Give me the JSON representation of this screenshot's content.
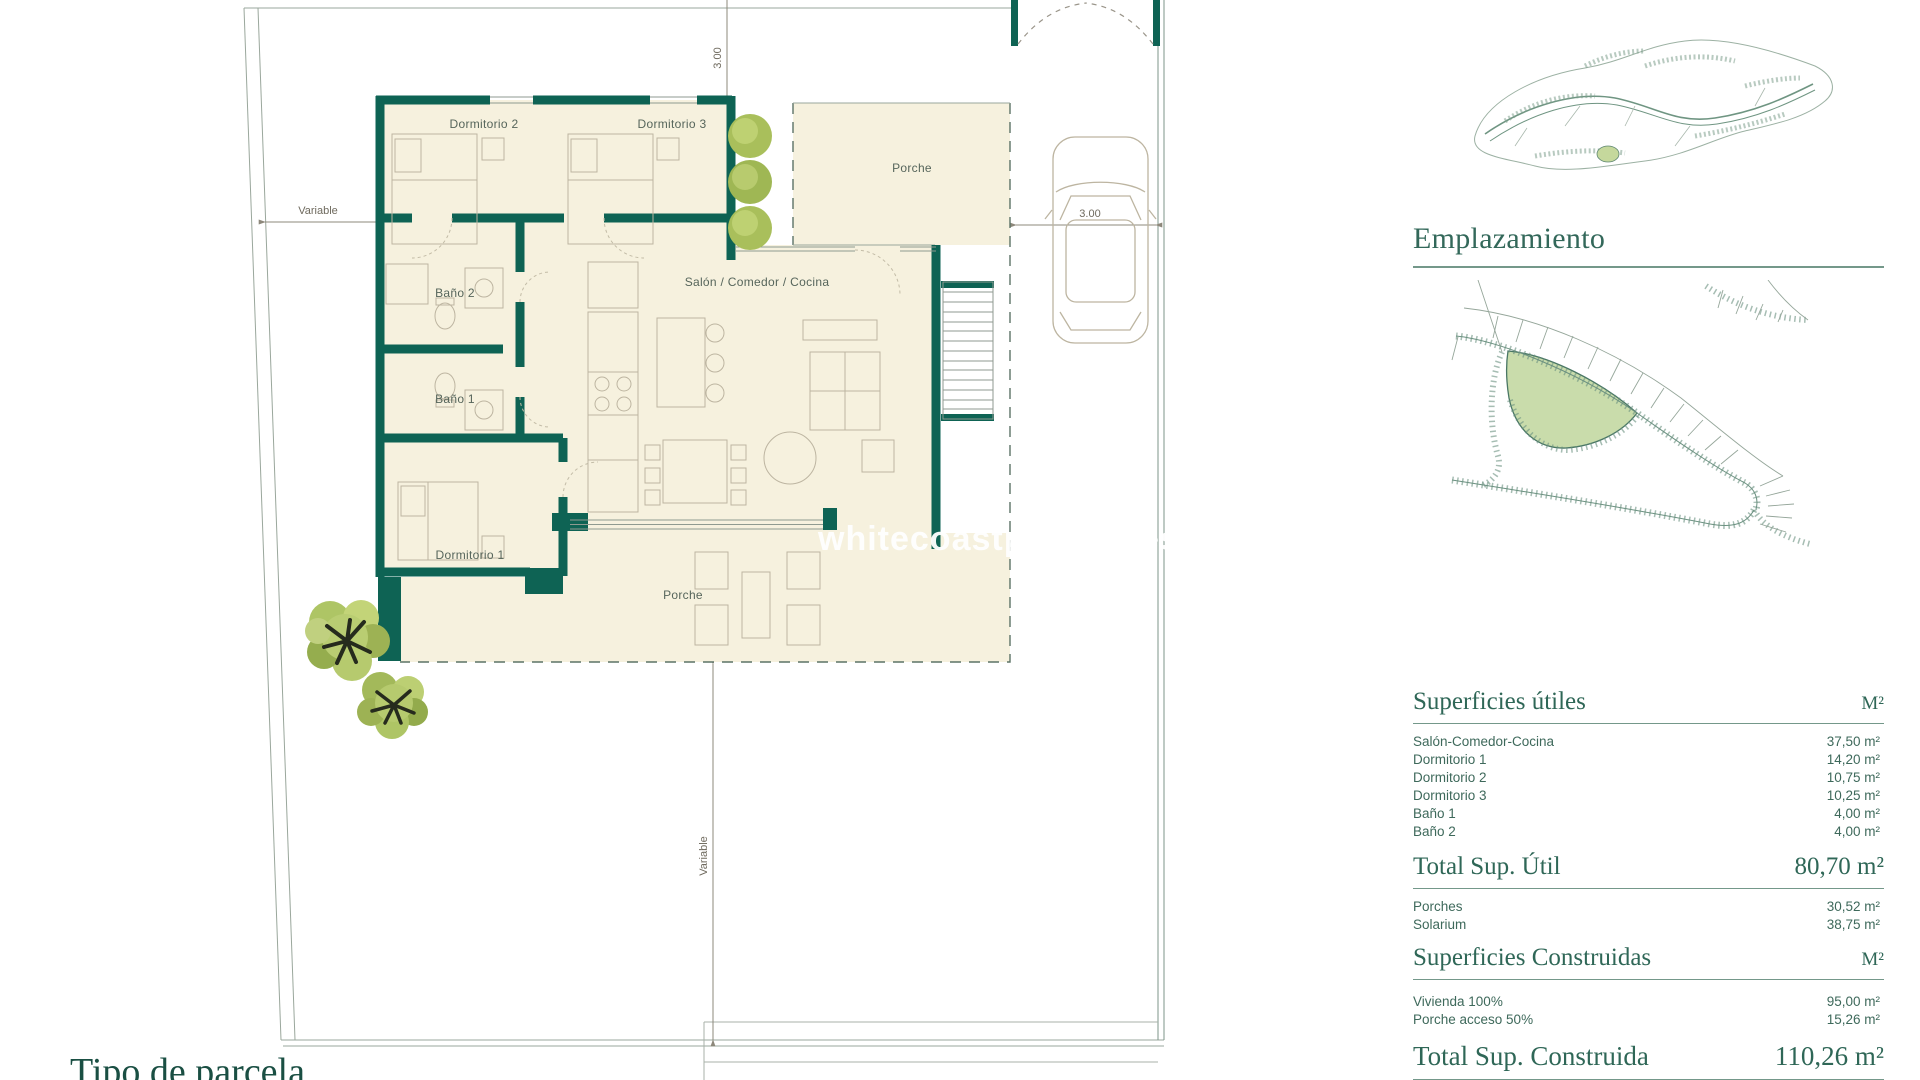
{
  "floor_plan": {
    "watermark": "whitecoastproperties",
    "rooms": {
      "dormitorio2": "Dormitorio 2",
      "dormitorio3": "Dormitorio 3",
      "porche_superior": "Porche",
      "salon": "Salón / Comedor / Cocina",
      "bano2": "Baño 2",
      "bano1": "Baño 1",
      "dormitorio1": "Dormitorio 1",
      "porche_inferior": "Porche"
    },
    "dimensions": {
      "variable_izquierda": "Variable",
      "ancho_superior": "3.00",
      "aparcamiento": "3.00",
      "variable_inferior": "Variable"
    }
  },
  "sidebar": {
    "emplazamiento_title": "Emplazamiento",
    "superficies_utiles": {
      "title": "Superficies útiles",
      "unit": "M²",
      "rows": [
        {
          "name": "Salón-Comedor-Cocina",
          "value": "37,50 m²"
        },
        {
          "name": "Dormitorio 1",
          "value": "14,20 m²"
        },
        {
          "name": "Dormitorio 2",
          "value": "10,75 m²"
        },
        {
          "name": "Dormitorio 3",
          "value": "10,25 m²"
        },
        {
          "name": "Baño 1",
          "value": "4,00 m²"
        },
        {
          "name": "Baño 2",
          "value": "4,00 m²"
        }
      ]
    },
    "total_util": {
      "label": "Total Sup. Útil",
      "value": "80,70 m²"
    },
    "extras": {
      "rows": [
        {
          "name": "Porches",
          "value": "30,52 m²"
        },
        {
          "name": "Solarium",
          "value": "38,75 m²"
        }
      ]
    },
    "superficies_construidas": {
      "title": "Superficies Construidas",
      "unit": "M²",
      "rows": [
        {
          "name": "Vivienda 100%",
          "value": "95,00 m²"
        },
        {
          "name": "Porche acceso 50%",
          "value": "15,26 m²"
        }
      ]
    },
    "total_construida": {
      "label": "Total Sup. Construida",
      "value": "110,26 m²"
    }
  },
  "footer": {
    "section_title": "Tipo de parcela"
  }
}
